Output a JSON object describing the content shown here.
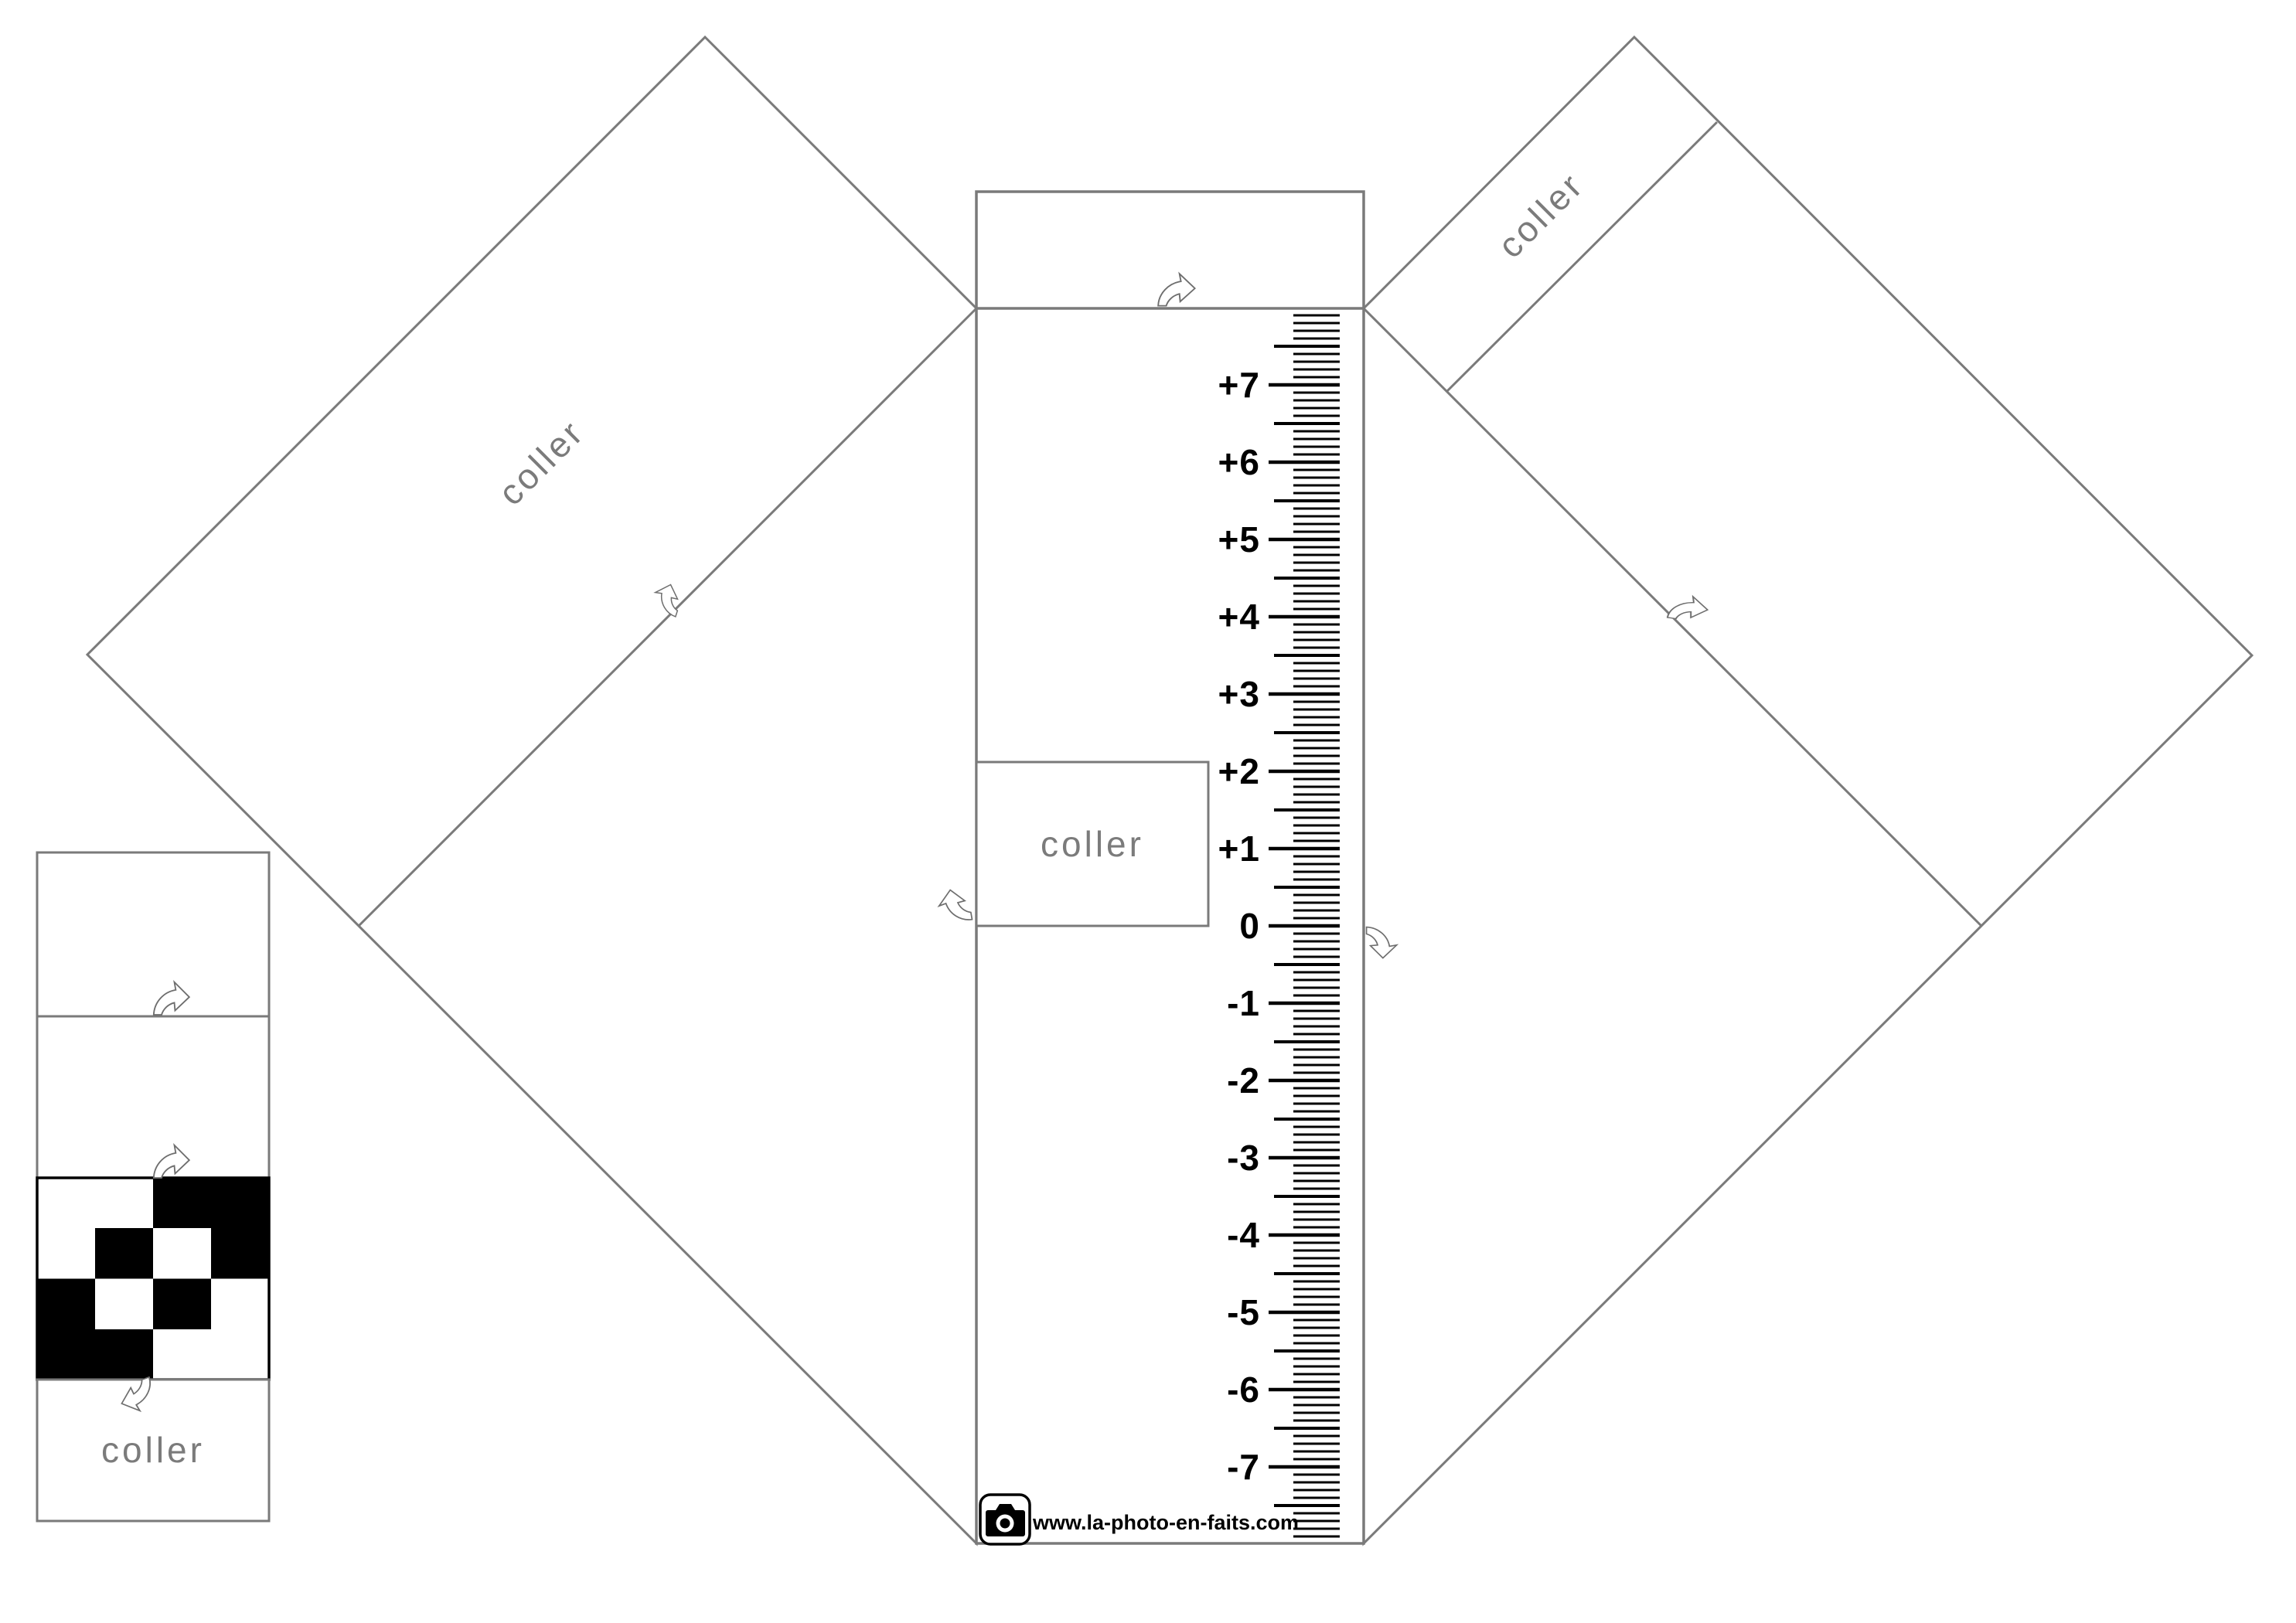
{
  "panels": {
    "left_panel": {
      "glue_label": "coller"
    },
    "right_panel": {
      "glue_label": "coller"
    },
    "column_patch": {
      "glue_label": "coller"
    },
    "strip": {
      "glue_label": "coller"
    }
  },
  "ruler": {
    "min": -7,
    "max": 7,
    "step": 1,
    "labels": [
      "+7",
      "+6",
      "+5",
      "+4",
      "+3",
      "+2",
      "+1",
      "0",
      "-1",
      "-2",
      "-3",
      "-4",
      "-5",
      "-6",
      "-7"
    ]
  },
  "footer": {
    "website": "www.la-photo-en-faits.com"
  },
  "checker": {
    "outer": [
      [
        "white",
        "black"
      ],
      [
        "black",
        "white"
      ]
    ],
    "inner": [
      [
        "black",
        "white"
      ],
      [
        "white",
        "black"
      ]
    ]
  },
  "colors": {
    "outline": "#7a7a7a",
    "text_gray": "#7b7b7b",
    "ink": "#000000",
    "paper": "#ffffff"
  },
  "icons": {
    "fold_arrow": "curved-fold-arrow",
    "logo": "camera-icon"
  }
}
